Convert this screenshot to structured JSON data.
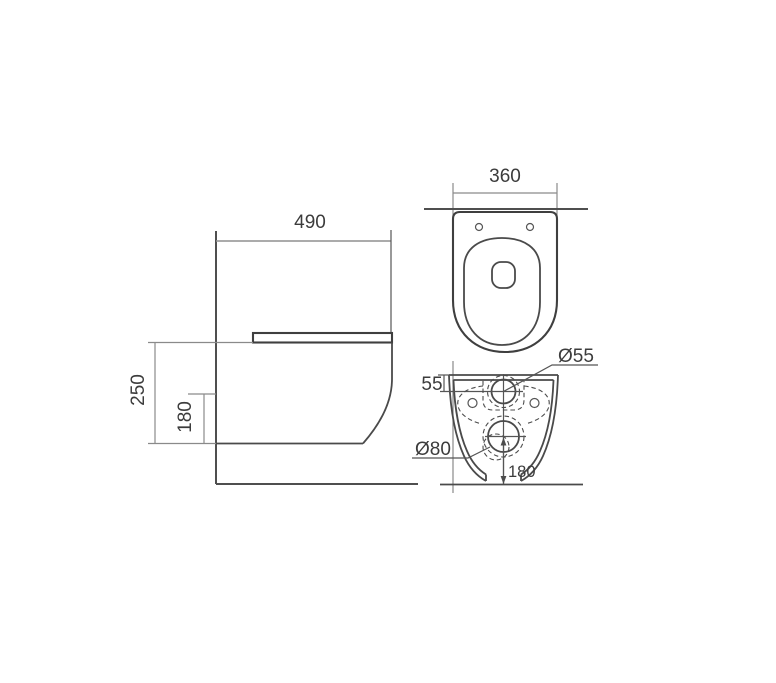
{
  "drawing": {
    "type": "wall-hung toilet technical dimension drawing",
    "side_view": {
      "name": "side view",
      "depth_label": "490",
      "height_label": "250",
      "outlet_height_label": "180"
    },
    "top_view": {
      "name": "top view",
      "width_label": "360"
    },
    "rear_view": {
      "name": "rear view",
      "inlet_offset_label": "55",
      "inlet_diameter_label": "Ø55",
      "outlet_diameter_label": "Ø80",
      "outlet_center_height_label": "180"
    },
    "colors": {
      "background": "#ffffff",
      "outline": "#4a4a4a",
      "dimension_lines": "#8a8a8a",
      "text": "#3c3c3c"
    }
  }
}
